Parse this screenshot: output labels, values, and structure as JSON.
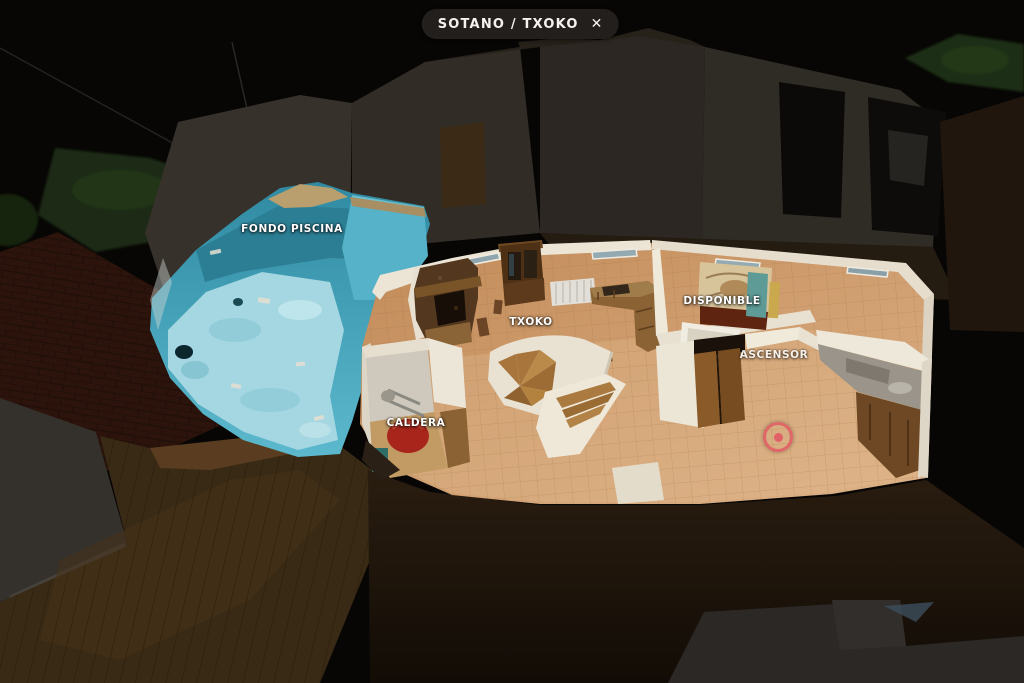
{
  "header": {
    "floor_label": "SOTANO / TXOKO",
    "close_icon": "✕"
  },
  "scene": {
    "view_type": "3d-dollhouse-floorplan",
    "labels": [
      {
        "id": "fondo-piscina",
        "text": "FONDO PISCINA"
      },
      {
        "id": "txoko",
        "text": "TXOKO"
      },
      {
        "id": "disponible",
        "text": "DISPONIBLE"
      },
      {
        "id": "ascensor",
        "text": "ASCENSOR"
      },
      {
        "id": "caldera",
        "text": "CALDERA"
      }
    ],
    "marker": {
      "color": "#e25964"
    }
  },
  "colors": {
    "background": "#070605",
    "badge_background": "#24211d",
    "badge_text": "#f4f3f1",
    "label_text": "#ffffff",
    "pool_teal": "#3e98ae",
    "pool_floor": "#a4d7e2",
    "tile_floor": "#cf9a66",
    "wall_cream": "#ece5d6",
    "marker_red": "#e25964"
  }
}
